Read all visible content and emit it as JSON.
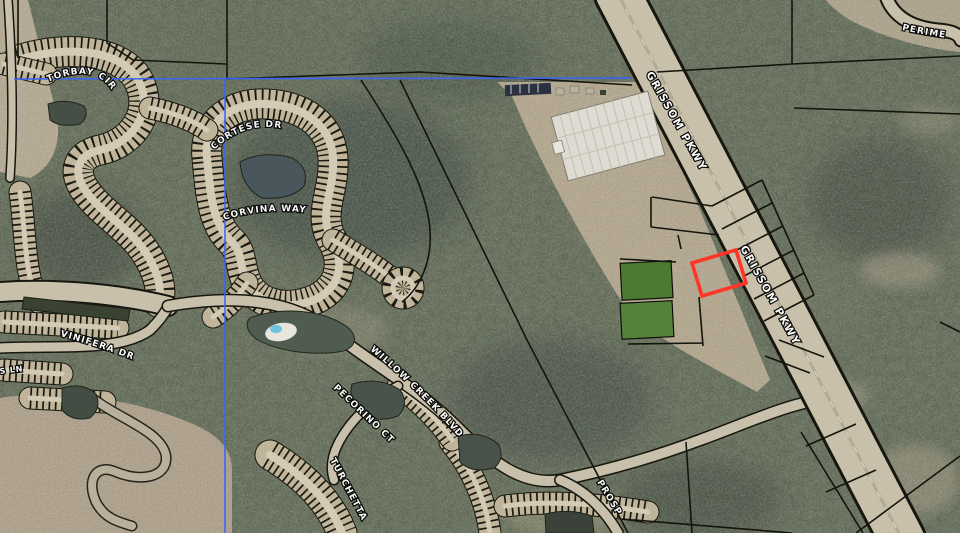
{
  "map": {
    "labels": {
      "grissom_top": "GRISSOM PKWY",
      "grissom_mid": "GRISSOM PKWY",
      "perimeter": "PERIME",
      "torbay": "TORBAY CIR",
      "cortese": "CORTESE DR",
      "corvina": "CORVINA WAY",
      "vinifera": "VINIFERA DR",
      "s_ln": "S LN",
      "willow_creek": "WILLOW CREEK BLVD",
      "pecorino": "PECORINO CT",
      "turchetta": "TURCHETTA",
      "prosperity": "PROSP"
    },
    "highlight": {
      "name": "selected-parcel",
      "color": "#ff3526"
    },
    "boundary_color": "#3b66f5",
    "parcel_line_color": "#14140c",
    "label_text_color": "#ffffff"
  }
}
